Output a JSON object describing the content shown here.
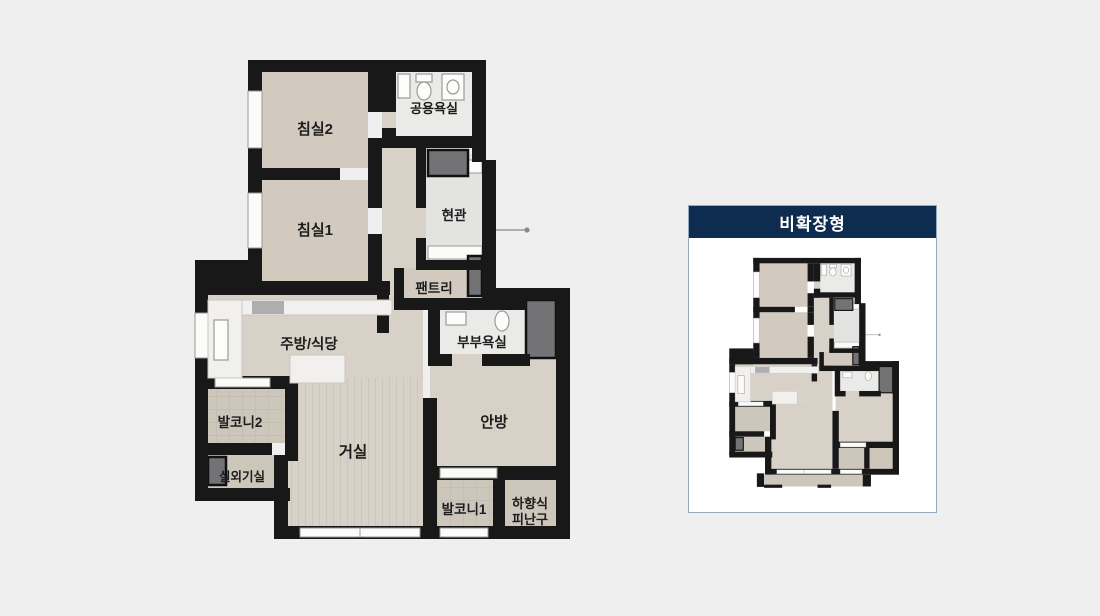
{
  "main_plan": {
    "rooms": {
      "bedroom2": "침실2",
      "common_bath": "공용욕실",
      "entrance": "현관",
      "bedroom1": "침실1",
      "pantry": "팬트리",
      "kitchen_dining": "주방/식당",
      "master_bath": "부부욕실",
      "balcony2": "발코니2",
      "living": "거실",
      "master_bedroom": "안방",
      "ac_room": "실외기실",
      "balcony1": "발코니1",
      "evac_hatch_line1": "하향식",
      "evac_hatch_line2": "피난구"
    }
  },
  "panel": {
    "title": "비확장형"
  },
  "colors": {
    "background": "#efefef",
    "wall": "#181818",
    "floor_wood": "#d7d1c7",
    "floor_bedroom": "#d2cabf",
    "floor_tile_bath": "#eaeae8",
    "floor_tile_balcony": "#ccc6bb",
    "duct_grey": "#737376",
    "panel_navy": "#0e2c50",
    "panel_border": "#93a9c0",
    "label_text": "#1d1d1d"
  }
}
